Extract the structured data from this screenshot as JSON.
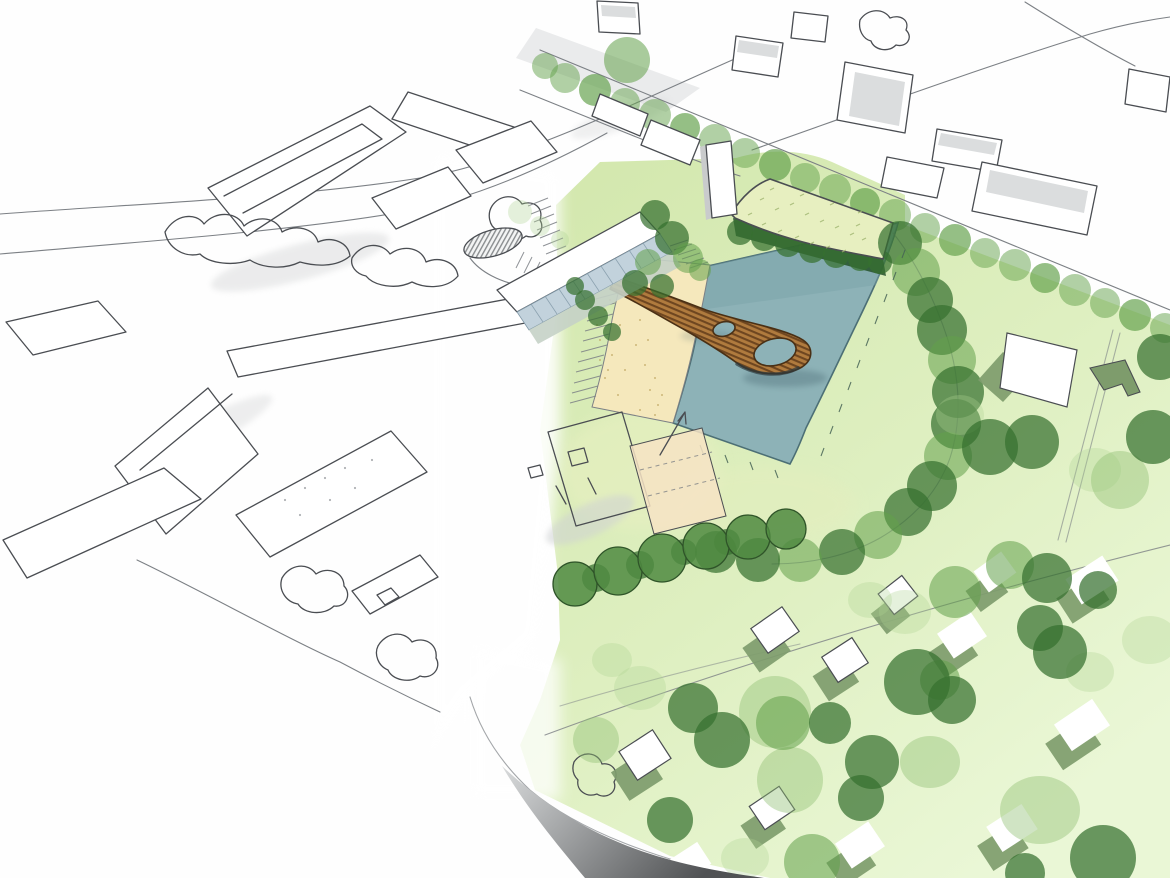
{
  "meta": {
    "title": "Hand-drawn aerial masterplan sketch with lake, looped timber bridge and villa meadow",
    "image_type": "architectural concept perspective sketch (no text in image)"
  },
  "colors": {
    "paper": "#FEFEFE",
    "ink": "#4A4D52",
    "ink-soft": "#7C8085",
    "water": "#8DB2B7",
    "water-edge": "#4C6F75",
    "sand": "#F5E8BC",
    "sand-dot": "#C4AD6C",
    "lawn-a": "#D2E7AC",
    "lawn-b": "#DEEFC0",
    "lawn-c": "#EAF7D6",
    "tree-dark": "#36702F",
    "tree-mid": "#63A14B",
    "tree-light": "#8FBE72",
    "tree-faint": "#AFD393",
    "hedge-fill": "#4F8A41",
    "hedge-ink": "#2F5429",
    "wood": "#B07B3E",
    "wood-hatch": "#6E4620",
    "wood-dark": "#2E3B3E",
    "roof-pav": "#E7EFC0",
    "pav-dash": "#9FB56F",
    "pav-under": "#24512A",
    "glass": "#C2D2DC",
    "glass-line": "#7F97A6",
    "glass-low": "#C5D2C6",
    "gray-roof": "#DBDDDE",
    "gray-side": "#C9CBCC",
    "house-shadow": "#7E9C6C",
    "edge-light": "#D9DBDC",
    "edge-dark": "#505254",
    "road-gray": "#D9DBDC",
    "reed": "#466355"
  },
  "scene": {
    "description": "Aerial hand sketch: pen-drawn city blocks on the left fade into a watercolour site with a rectangular lake, sandy beach, a looping timber bridge, a green-roof pavilion, tree belts and a pale-green meadow dotted with white villas.",
    "elements": [
      {
        "name": "context-city-blocks-sketch",
        "desc": "uncoloured pen-sketched urban blocks and roads, left and top"
      },
      {
        "name": "street-tree-avenue",
        "desc": "diagonal road lined with a row of round green trees"
      },
      {
        "name": "lake",
        "desc": "rectangular teal pond in perspective"
      },
      {
        "name": "sand-beach",
        "desc": "speckled sandy strip on the west bank of the lake"
      },
      {
        "name": "loop-bridge",
        "desc": "hatched timber deck looping over the water with two eyelets"
      },
      {
        "name": "green-roof-pavilion",
        "desc": "long pavilion with pale-green speckled roof on dark colonnade, north of lake"
      },
      {
        "name": "glazed-waterfront-building",
        "desc": "bar building with blue-grey glass facade facing the beach"
      },
      {
        "name": "viewing-tower",
        "desc": "slim white tower beside the pavilion"
      },
      {
        "name": "grand-steps",
        "desc": "hatched stair flights descending to the beach"
      },
      {
        "name": "sports-courts",
        "desc": "sketched white and pale-orange courts south-west of the beach"
      },
      {
        "name": "small-courtyard-pond",
        "desc": "hatched oval pond inside the sketched courtyard block"
      },
      {
        "name": "perimeter-tree-band",
        "desc": "dense dark-green tree belt wrapping the lake's east and south sides"
      },
      {
        "name": "hedge-row",
        "desc": "scalloped outlined tree row along the south site edge"
      },
      {
        "name": "villa-meadow",
        "desc": "pale green lawn with scattered translucent trees"
      },
      {
        "name": "villa-houses",
        "desc": "small white boxes casting sage-green shadows across the meadow"
      },
      {
        "name": "lawn-path",
        "desc": "thin curved path lines crossing the meadow"
      },
      {
        "name": "model-edge-shadow",
        "desc": "grey graded cut edge at the bottom of the green plane"
      }
    ]
  }
}
